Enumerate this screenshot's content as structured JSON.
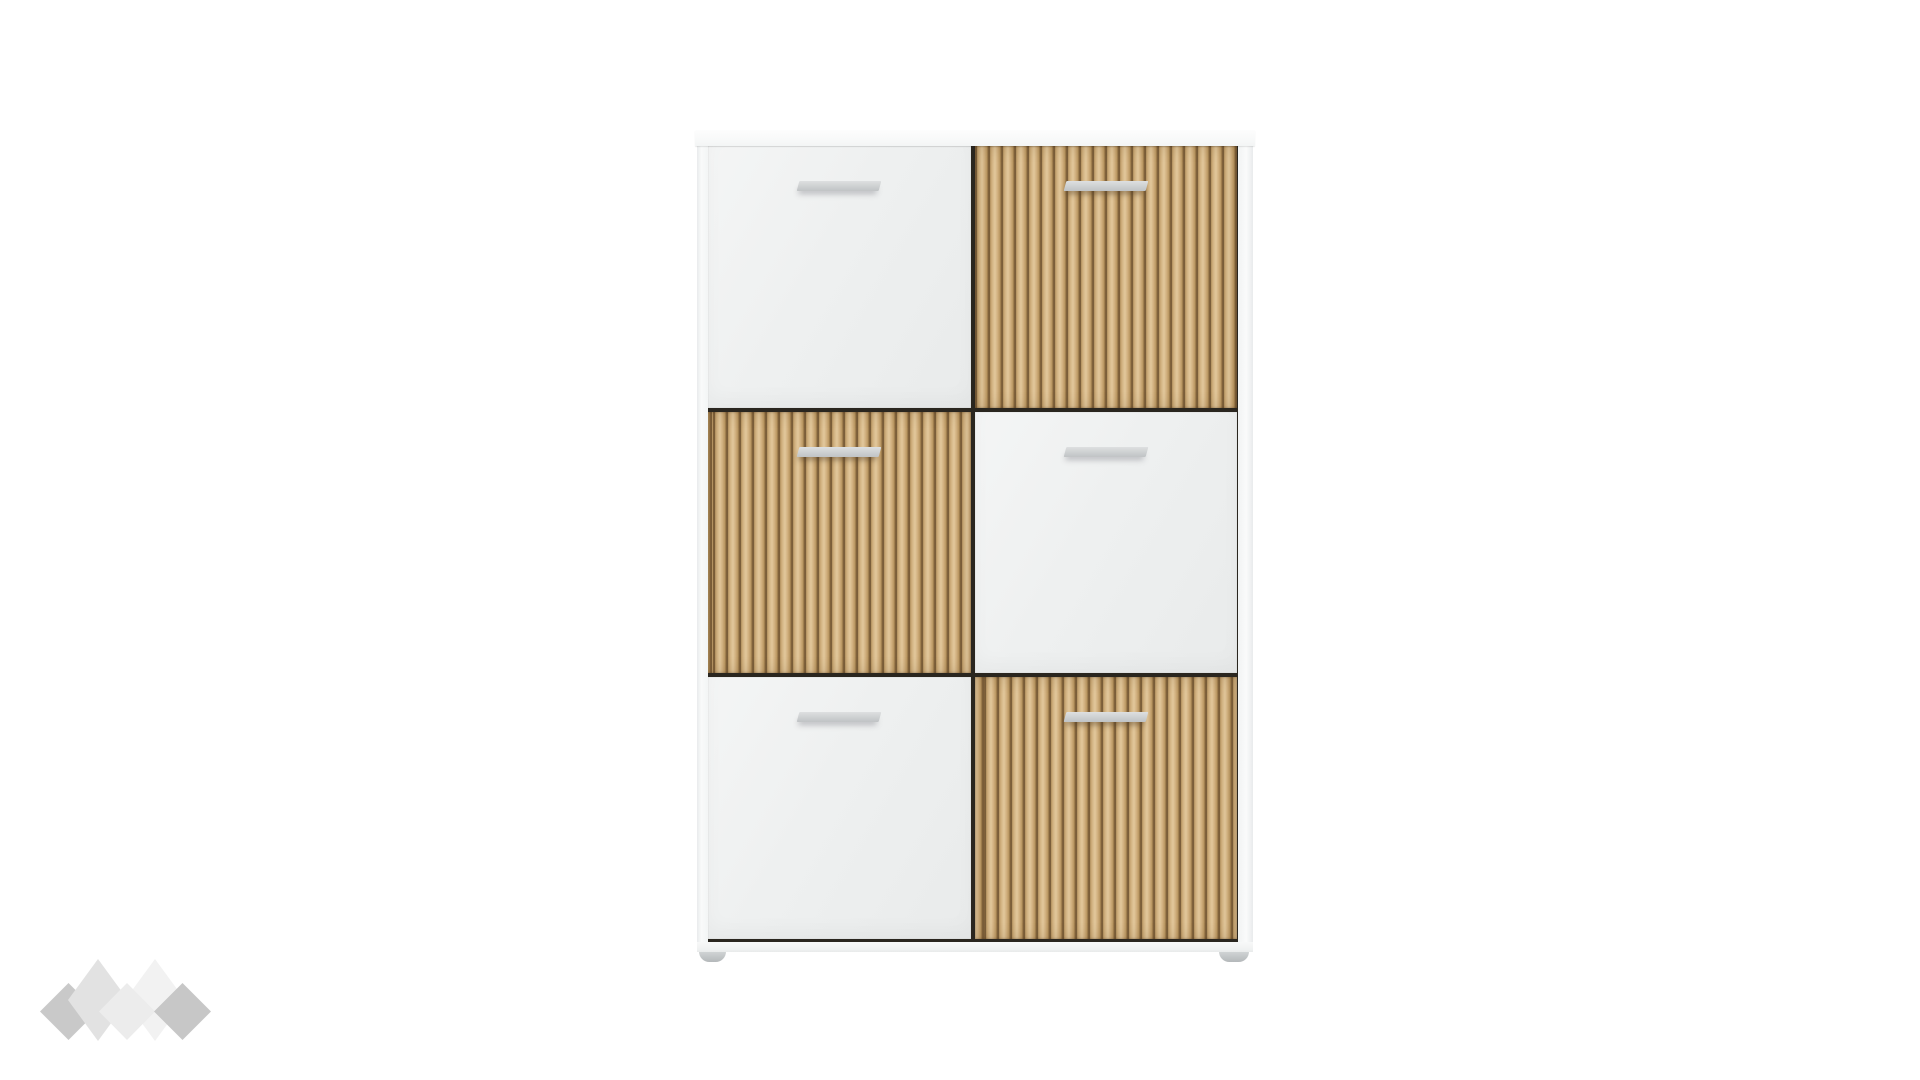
{
  "page": {
    "type": "product-photo",
    "description": "Six-door checkerboard storage cabinet with white and ribbed oak slat fronts, gray bar handles, on small gray feet, against a plain white background with a gray diamond brand watermark in the bottom-left corner"
  },
  "colors": {
    "background": "#ffffff",
    "carcass_white": "#f8f9f9",
    "door_white": "#eef0f0",
    "oak_base": "#cfae7c",
    "oak_groove": "#6e5331",
    "handle_gray": "#c0c3c5",
    "gap_dark": "#2a261f",
    "foot_gray": "#c4c8c9"
  },
  "cabinet": {
    "grid": {
      "rows": 3,
      "cols": 2
    },
    "pattern": "checkerboard",
    "doors": [
      {
        "id": "door-top-left",
        "row": 1,
        "col": 1,
        "material": "white",
        "handle": true
      },
      {
        "id": "door-top-right",
        "row": 1,
        "col": 2,
        "material": "oak",
        "handle": true
      },
      {
        "id": "door-middle-left",
        "row": 2,
        "col": 1,
        "material": "oak",
        "handle": true
      },
      {
        "id": "door-middle-right",
        "row": 2,
        "col": 2,
        "material": "white",
        "handle": true
      },
      {
        "id": "door-bottom-left",
        "row": 3,
        "col": 1,
        "material": "white",
        "handle": true
      },
      {
        "id": "door-bottom-right",
        "row": 3,
        "col": 2,
        "material": "oak",
        "handle": true
      }
    ],
    "feet_count": 2
  },
  "watermark": {
    "diamonds": [
      {
        "x": 40,
        "y": 983,
        "w": 57,
        "h": 57,
        "color": "#c9c9c9",
        "z": 1
      },
      {
        "x": 68,
        "y": 959,
        "w": 60,
        "h": 82,
        "color": "#e2e2e2",
        "z": 2
      },
      {
        "x": 125,
        "y": 959,
        "w": 60,
        "h": 82,
        "color": "#f2f2f2",
        "z": 3
      },
      {
        "x": 99,
        "y": 983,
        "w": 56,
        "h": 57,
        "color": "#ececec",
        "z": 4
      },
      {
        "x": 154,
        "y": 983,
        "w": 57,
        "h": 57,
        "color": "#c7c7c7",
        "z": 5
      }
    ]
  }
}
